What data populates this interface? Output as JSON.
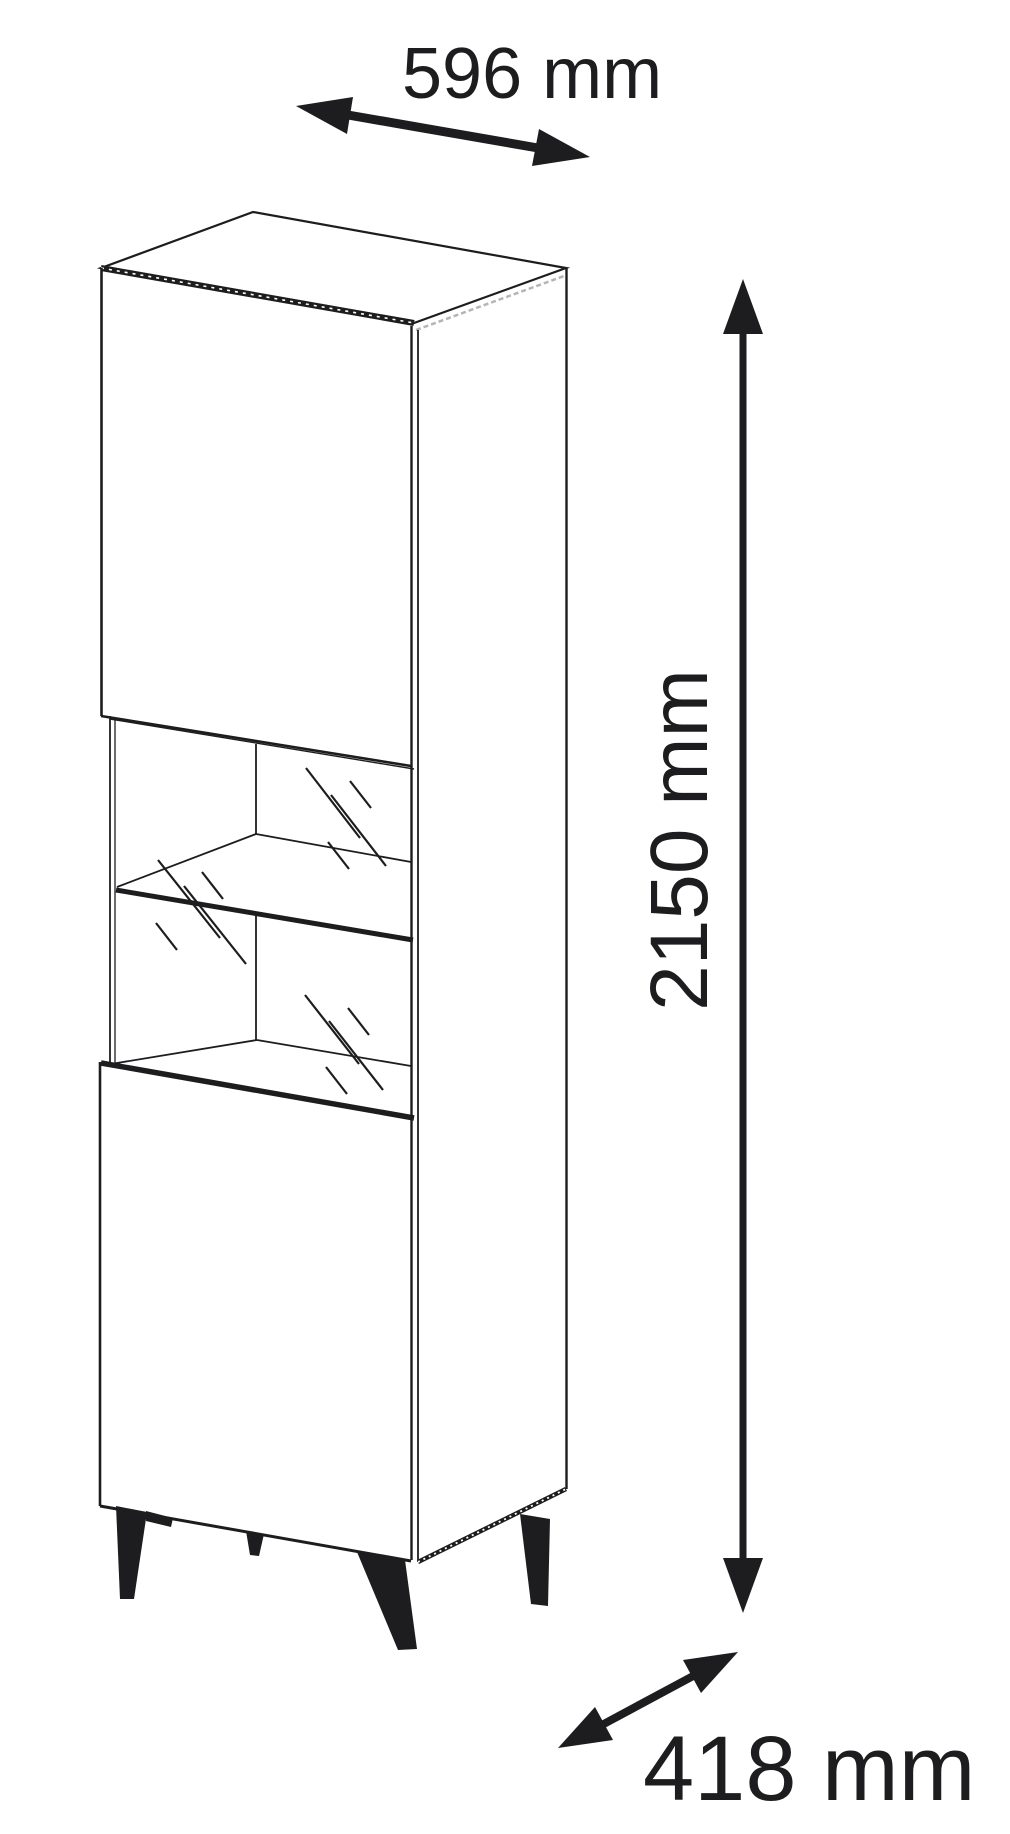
{
  "page": {
    "background_color": "#ffffff",
    "line_color": "#1d1d1f",
    "accent_gray": "#b5b5b5"
  },
  "diagram": {
    "type": "furniture-dimension-drawing",
    "object": "tall display cabinet with two doors, glass showcase middle section, glass shelf and four tapered legs",
    "dimensions": {
      "width": {
        "value": 596,
        "unit": "mm",
        "label": "596 mm"
      },
      "height": {
        "value": 2150,
        "unit": "mm",
        "label": "2150 mm"
      },
      "depth": {
        "value": 418,
        "unit": "mm",
        "label": "418 mm"
      }
    }
  }
}
